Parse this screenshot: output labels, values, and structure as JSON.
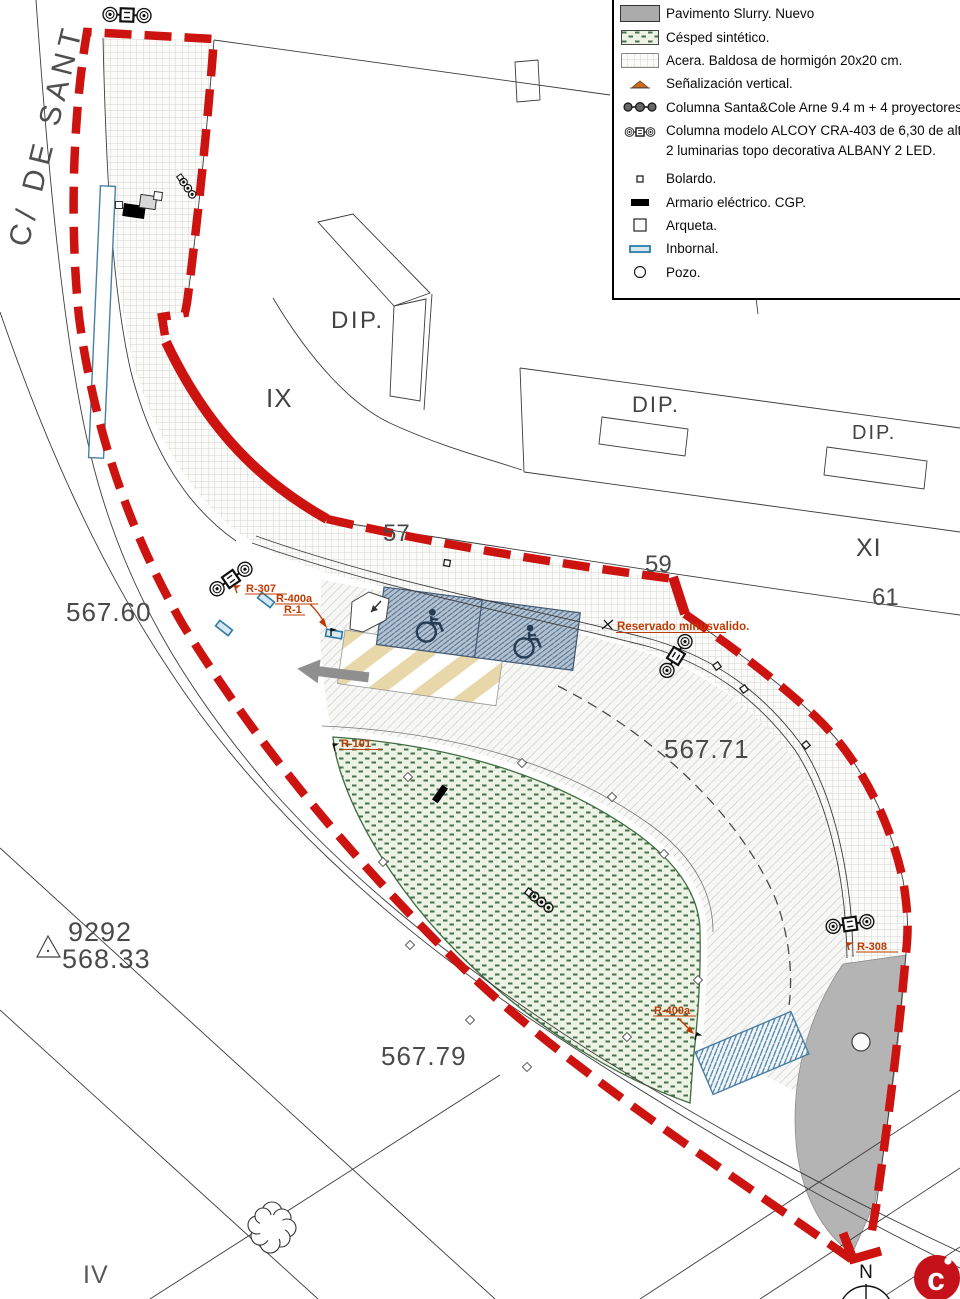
{
  "legend": {
    "items": [
      {
        "icon": "slurry-swatch",
        "label": "Pavimento Slurry. Nuevo"
      },
      {
        "icon": "grass-swatch",
        "label": "Césped sintético."
      },
      {
        "icon": "sidewalk-swatch",
        "label": "Acera. Baldosa de hormigón 20x20 cm."
      },
      {
        "icon": "vertical-sign-icon",
        "label": "Señalización vertical."
      },
      {
        "icon": "column-santacole-icon",
        "label": "Columna Santa&Cole Arne 9.4 m + 4 proyectores"
      },
      {
        "icon": "column-alcoy-icon",
        "label": "Columna modelo ALCOY CRA-403 de 6,30 de alt",
        "label2": "2 luminarias topo decorativa ALBANY 2 LED."
      },
      {
        "icon": "bolardo-icon",
        "label": "Bolardo."
      },
      {
        "icon": "armario-icon",
        "label": "Armario eléctrico. CGP."
      },
      {
        "icon": "arqueta-icon",
        "label": "Arqueta."
      },
      {
        "icon": "inbornal-icon",
        "label": "Inbornal."
      },
      {
        "icon": "pozo-icon",
        "label": "Pozo."
      }
    ]
  },
  "plan": {
    "street_name": "C/ DE SANT",
    "block_labels": {
      "ix": "IX",
      "xi": "XI",
      "iv": "IV"
    },
    "building_labels": {
      "dip1": "DIP.",
      "dip2": "DIP.",
      "dip3": "DIP."
    },
    "parcel_numbers": {
      "n57": "57",
      "n59": "59",
      "n61": "61"
    },
    "elevations": {
      "e_567_60": "567.60",
      "e_567_71": "567.71",
      "e_567_79": "567.79"
    },
    "benchmark": {
      "id": "9292",
      "elevation": "568.33"
    },
    "signs": {
      "r307": "R-307",
      "r400a_a": "R-400a",
      "r1": "R-1",
      "r101": "R-101",
      "r400a_b": "R-400a",
      "r308": "R-308",
      "reservado": "Reservado minusvalido."
    },
    "compass_north": "N",
    "logo_letter": "c"
  },
  "colors": {
    "boundary_red": "#cc1310",
    "slurry_gray": "#b4b4b4",
    "grass_green": "#46714a",
    "parking_blue": "#b3c2d3",
    "inbornal_blue": "#2d7ca6",
    "zebra_beige": "#e8d7a8",
    "sign_label_red": "#bf3a00",
    "logo_red": "#c5121a"
  }
}
